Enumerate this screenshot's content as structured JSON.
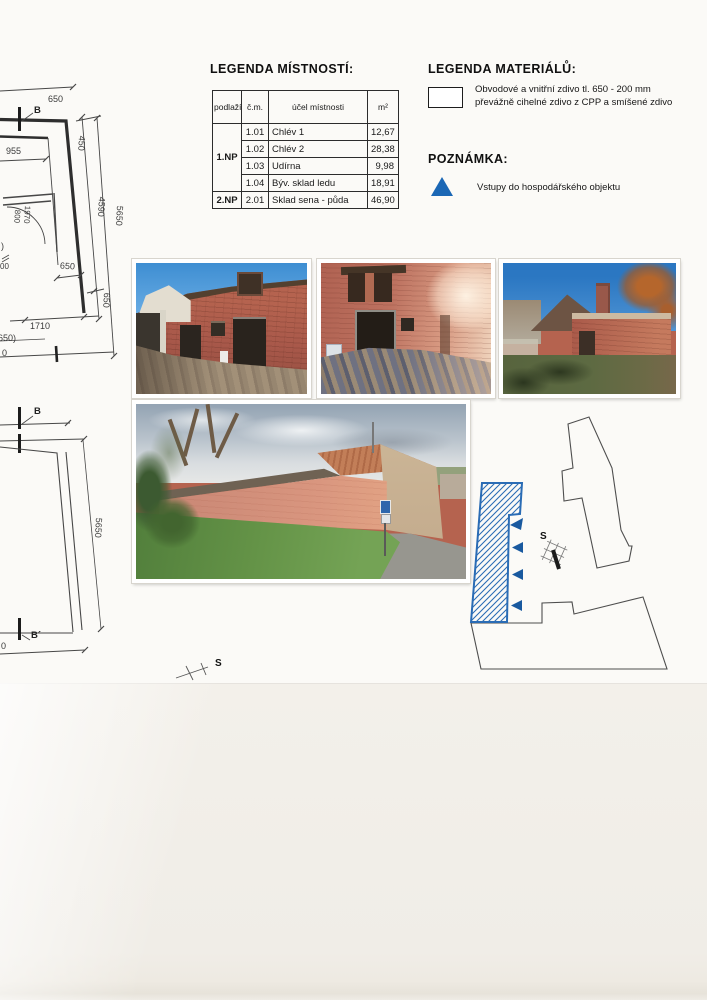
{
  "colors": {
    "accent_blue": "#2a6cb5",
    "triangle_blue": "#1b67b5",
    "paper_white": "#fbfaf7",
    "paper_cream": "#f1eee8",
    "ink": "#3a3a3a"
  },
  "legend_rooms": {
    "title": "LEGENDA MÍSTNOSTÍ:",
    "headers": {
      "floor": "podlaží",
      "number": "č.m.",
      "purpose": "účel místnosti",
      "area": "m²"
    },
    "floor1_label": "1.NP",
    "floor2_label": "2.NP",
    "rows": [
      {
        "number": "1.01",
        "purpose": "Chlév 1",
        "area": "12,67"
      },
      {
        "number": "1.02",
        "purpose": "Chlév 2",
        "area": "28,38"
      },
      {
        "number": "1.03",
        "purpose": "Udírna",
        "area": "9,98"
      },
      {
        "number": "1.04",
        "purpose": "Býv. sklad ledu",
        "area": "18,91"
      },
      {
        "number": "2.01",
        "purpose": "Sklad sena - půda",
        "area": "46,90"
      }
    ]
  },
  "legend_materials": {
    "title": "LEGENDA MATERIÁLŮ:",
    "item_line1": "Obvodové a vnitřní zdivo tl. 650 - 200 mm",
    "item_line2": "převážně cihelné zdivo z CPP a smíšené zdivo"
  },
  "note": {
    "title": "POZNÁMKA:",
    "item": "Vstupy do hospodářského objektu"
  },
  "floorplan_partial": {
    "dim_650_top": "650",
    "section_b": "B",
    "dim_955": "955",
    "dim_450": "450",
    "dim_4590": "4590",
    "dim_5650": "5650",
    "door_800": "800",
    "door_1970": "1970",
    "dim_650_mid": "650",
    "dim_650_side": "650",
    "dim_1710": "1710",
    "dim_650_cut": "(650)",
    "partial_paren": ")",
    "partial_00": "00",
    "partial_zero": "0"
  },
  "section_drawing": {
    "section_b": "B",
    "section_b_prime": "B´",
    "dim_5650": "5650",
    "partial_zero": "0",
    "north_label": "S"
  },
  "siteplan": {
    "north_label": "S"
  }
}
